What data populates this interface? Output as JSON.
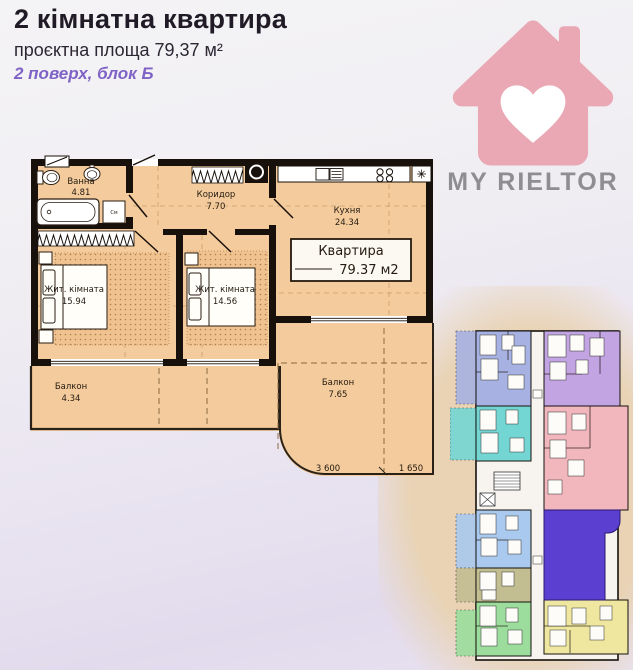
{
  "header": {
    "title": "2 кімнатна квартира",
    "area_line": "проєктна площа 79,37 м²",
    "floor_line": "2 поверх, блок Б"
  },
  "logo": {
    "brand": "MY RIELTOR"
  },
  "plan": {
    "rooms": {
      "bath": {
        "name": "Ванна",
        "area": "4.81"
      },
      "corridor": {
        "name": "Коридор",
        "area": "7.70"
      },
      "kitchen": {
        "name": "Кухня",
        "area": "24.34"
      },
      "bedroom1": {
        "name": "Жит. кімната",
        "area": "15.94"
      },
      "bedroom2": {
        "name": "Жит. кімната",
        "area": "14.56"
      },
      "balcony_left": {
        "name": "Балкон",
        "area": "4.34"
      },
      "balcony_right": {
        "name": "Балкон",
        "area": "7.65"
      }
    },
    "apartment_stamp": {
      "title": "Квартира",
      "area": "79.37 м2"
    },
    "dims": {
      "d1": "3 600",
      "d2": "1 650"
    },
    "washer_label": "См"
  },
  "colors": {
    "accent_purple": "#7e62c6",
    "logo_pink": "#e9a8b4",
    "logo_gray": "#8e8d90",
    "plan_fill": "#f4cb9c",
    "wall": "#18100a",
    "tan_backdrop": "#e9d3b4",
    "highlight_apartment": "#5b3fd0",
    "minimap": {
      "periwinkle": "#a7b2e2",
      "cyan": "#74d6d3",
      "violet": "#c3a4e2",
      "pink": "#f2b6bd",
      "lightblue": "#a9c9ee",
      "olive": "#c3bd92",
      "green": "#9cdd9d",
      "yellow": "#efe79f"
    }
  }
}
